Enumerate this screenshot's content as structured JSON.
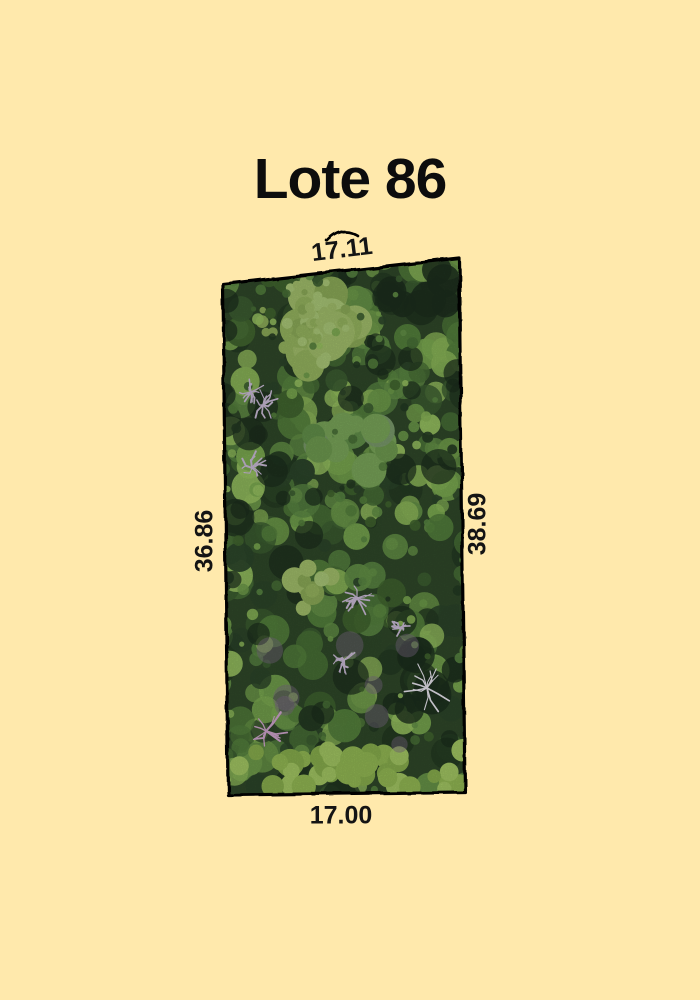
{
  "page": {
    "background_color": "#FFE9AC"
  },
  "header": {
    "title": "Lote 86"
  },
  "lot": {
    "boundary_color": "#000000",
    "dimensions": {
      "top": "17.11",
      "left": "36.86",
      "right": "38.69",
      "bottom": "17.00"
    }
  },
  "forest": {
    "base_color": "#2f4829",
    "palette": [
      "#6e9b4a",
      "#7cab51",
      "#55813d",
      "#486f36",
      "#8ab558",
      "#3c5e31",
      "#2c452a",
      "#649147",
      "#97c160",
      "#41652f",
      "#243a22",
      "#5a8743"
    ],
    "canopy_highlight_colors": [
      "#a2bf6b",
      "#96b55f",
      "#aac878",
      "#8cab58"
    ],
    "mid_canopy_colors": [
      "#6f9b50",
      "#7aa65a",
      "#62904a",
      "#7a9a6b"
    ],
    "bottom_band_colors": [
      "#93b954",
      "#a3c763",
      "#88ae4d"
    ],
    "shadow_color": "#1c2e1d",
    "purple_patch_color": "#7d6b86",
    "skeletal_tree_colors": [
      "#e9e5ee",
      "#cbbcd8",
      "#d0a6ce"
    ]
  }
}
